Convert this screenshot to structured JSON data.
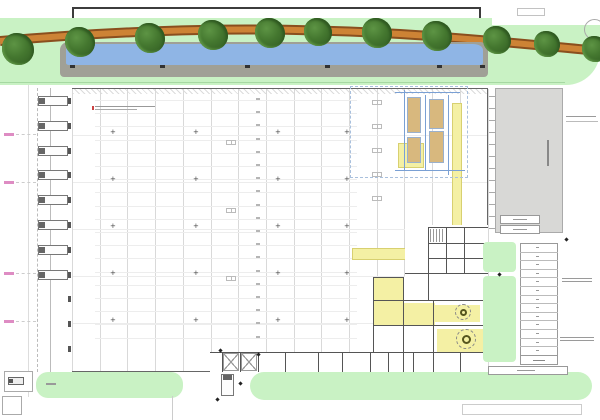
{
  "meta": {
    "title": "warehouse-site-plan",
    "canvas": {
      "w": 600,
      "h": 420
    }
  },
  "palette": {
    "green": "#c9f2c4",
    "water": "#8fb5e5",
    "canalWall": "#a0a096",
    "roadFill": "#cd8335",
    "roadEdge": "#8a4f1e",
    "treeDark": "#305a22",
    "treeMid": "#44772f",
    "treeLight": "#5d9444",
    "yard": "#d8d8d6",
    "yellow": "#f4f0a4",
    "tan": "#d8b87e",
    "blue": "#7aa0d4",
    "wall": "#555555",
    "grid": "#d9d9d9",
    "faint": "#ececec",
    "pink": "#d878b8",
    "olive": "#55551f",
    "ink": "#444444"
  },
  "plan": {
    "road": {
      "d": "M0,41 C140,29 260,26 400,34 C480,39 555,47 600,51"
    },
    "trees": [
      [
        18,
        49,
        16
      ],
      [
        80,
        42,
        15
      ],
      [
        150,
        38,
        15
      ],
      [
        213,
        35,
        15
      ],
      [
        270,
        33,
        15
      ],
      [
        318,
        32,
        14
      ],
      [
        377,
        33,
        15
      ],
      [
        437,
        36,
        15
      ],
      [
        497,
        40,
        14
      ],
      [
        547,
        44,
        13
      ],
      [
        595,
        49,
        13
      ]
    ],
    "canal": {
      "ticks": [
        70,
        160,
        245,
        325,
        437,
        480
      ],
      "tickY": 65
    },
    "grid": {
      "x0": 72,
      "dx": 27.7,
      "n": 16,
      "y0": 89,
      "y1": 371
    },
    "faintRows": [
      135,
      182,
      229,
      276,
      323
    ],
    "racks": {
      "x": 95,
      "w": 262,
      "y0": 100,
      "dy": 13.2,
      "yMax": 348,
      "tickX": 256
    },
    "colMarks": {
      "xs": [
        113,
        196,
        278,
        347
      ],
      "ys": [
        133,
        180,
        227,
        274,
        321
      ]
    },
    "sqCols": [
      {
        "x": 372,
        "y0": 100,
        "dy": 24,
        "yMax": 216
      },
      {
        "x": 226,
        "y0": 140,
        "dy": 68,
        "yMax": 340
      }
    ],
    "docks": {
      "x": 38,
      "y0": 96,
      "dy": 24.8,
      "n": 8,
      "w": 30,
      "h": 10
    },
    "bumpers": {
      "x": 68,
      "y0": 96,
      "dy": 24.8,
      "n": 11
    },
    "apron": {
      "dashX": 37,
      "lineX": 50,
      "edgeX": 28
    },
    "pinkLabels": [
      133,
      181,
      272,
      320
    ],
    "equipment": {
      "yellow": [
        [
          452,
          103,
          10,
          145
        ],
        [
          352,
          248,
          110,
          12
        ],
        [
          398,
          143,
          26,
          25
        ]
      ],
      "tan": [
        [
          407,
          97,
          14,
          36
        ],
        [
          407,
          137,
          14,
          26
        ],
        [
          429,
          99,
          15,
          30
        ],
        [
          429,
          131,
          15,
          32
        ]
      ],
      "blueV": [
        [
          404,
          90,
          80
        ],
        [
          425,
          95,
          75
        ],
        [
          448,
          95,
          80
        ]
      ],
      "blueH": [
        [
          395,
          92,
          65
        ],
        [
          395,
          170,
          70
        ]
      ],
      "dashBox": [
        350,
        86,
        118,
        92
      ]
    },
    "office": {
      "white": [
        [
          405,
          225,
          83,
          147
        ],
        [
          373,
          277,
          115,
          95
        ],
        [
          210,
          352,
          278,
          20
        ]
      ],
      "yellow": [
        [
          373,
          277,
          30,
          26
        ],
        [
          373,
          303,
          62,
          22
        ],
        [
          435,
          305,
          45,
          17
        ],
        [
          437,
          329,
          46,
          23
        ]
      ],
      "circles": [
        [
          463,
          312,
          8
        ],
        [
          466,
          339,
          10
        ]
      ],
      "stairs": [
        430,
        229,
        14,
        13
      ],
      "braces": [
        [
          223,
          353,
          16,
          18
        ],
        [
          241,
          353,
          16,
          18
        ]
      ]
    },
    "walls": {
      "v": [
        [
          373,
          277,
          75
        ],
        [
          403,
          277,
          75
        ],
        [
          428,
          227,
          73
        ],
        [
          446,
          227,
          46
        ],
        [
          464,
          227,
          46
        ],
        [
          433,
          300,
          72
        ],
        [
          222,
          352,
          20
        ],
        [
          240,
          352,
          20
        ],
        [
          258,
          352,
          20
        ],
        [
          285,
          352,
          20
        ],
        [
          318,
          352,
          20
        ],
        [
          342,
          352,
          20
        ],
        [
          370,
          352,
          20
        ],
        [
          388,
          352,
          20
        ],
        [
          403,
          352,
          20
        ],
        [
          413,
          352,
          20
        ],
        [
          433,
          352,
          20
        ],
        [
          460,
          352,
          20
        ]
      ],
      "h": [
        [
          428,
          227,
          60
        ],
        [
          428,
          243,
          60
        ],
        [
          428,
          258,
          60
        ],
        [
          405,
          273,
          83
        ],
        [
          373,
          277,
          30
        ],
        [
          373,
          300,
          115
        ],
        [
          373,
          325,
          115
        ],
        [
          210,
          352,
          278
        ]
      ]
    },
    "yard": {
      "textBar": [
        547,
        140,
        2,
        26
      ],
      "boxes": [
        [
          500,
          215,
          40,
          9
        ],
        [
          500,
          225,
          40,
          9
        ]
      ],
      "eastTicks": {
        "x": 489,
        "y0": 96,
        "dy": 12,
        "n": 12
      }
    },
    "parking": {
      "top": 243,
      "left": 520,
      "width": 38,
      "stalls": 13,
      "dy": 8.6,
      "totalBox": [
        520,
        355,
        38,
        10
      ]
    },
    "greens": [
      [
        36,
        372,
        147,
        26,
        12
      ],
      [
        250,
        372,
        342,
        28,
        14
      ],
      [
        483,
        242,
        33,
        30,
        4
      ],
      [
        483,
        276,
        33,
        86,
        4
      ]
    ],
    "southTruck": [
      221,
      374,
      13,
      22
    ],
    "gate": {
      "boxes": [
        [
          4,
          371,
          29,
          21
        ],
        [
          2,
          396,
          20,
          19
        ]
      ],
      "truck": [
        8,
        377,
        16,
        8
      ],
      "label": [
        46,
        383,
        10,
        2
      ]
    },
    "bottomBar": [
      462,
      404,
      120,
      11
    ],
    "bikeBar": [
      488,
      366,
      80,
      9
    ],
    "dots": [
      [
        219,
        349
      ],
      [
        257,
        353
      ],
      [
        239,
        382
      ],
      [
        216,
        398
      ],
      [
        565,
        238
      ],
      [
        498,
        273
      ]
    ],
    "annotations": [
      {
        "x": 566,
        "y": 116,
        "w": 30,
        "rows": 1
      },
      {
        "x": 562,
        "y": 278,
        "w": 30,
        "rows": 2
      },
      {
        "x": 560,
        "y": 337,
        "w": 34,
        "rows": 2
      }
    ],
    "annLine": [
      566,
      121,
      32
    ],
    "topNote": {
      "x": 95,
      "y": 106,
      "w": 60
    },
    "vline172": [
      172,
      396,
      24
    ]
  }
}
